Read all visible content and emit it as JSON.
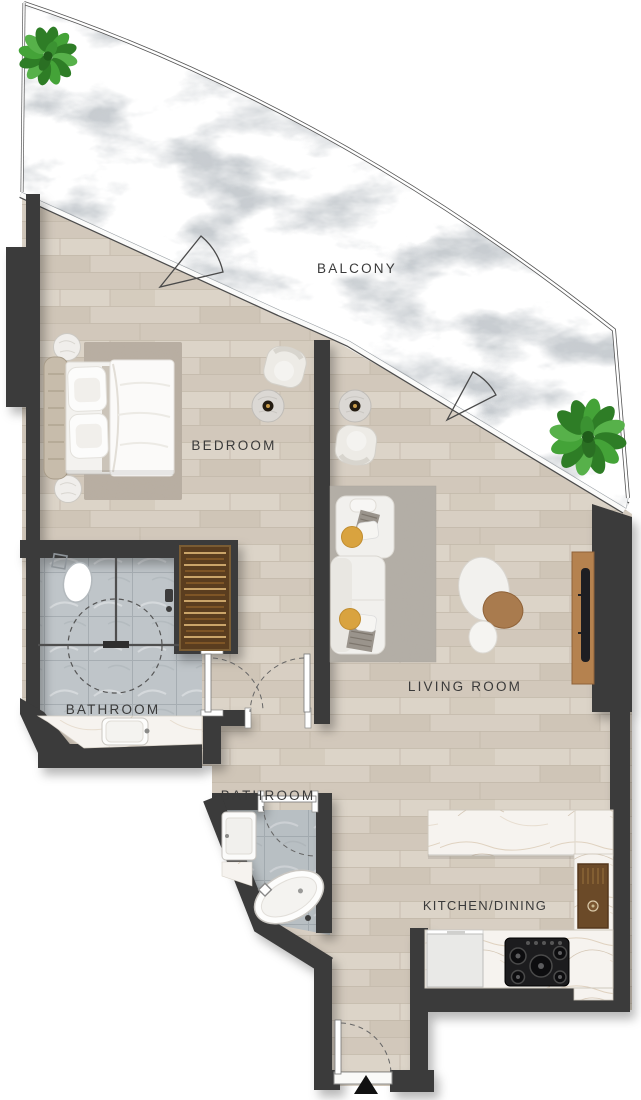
{
  "type": "floor-plan",
  "rooms": [
    {
      "id": "balcony",
      "label": "BALCONY"
    },
    {
      "id": "bedroom",
      "label": "BEDROOM"
    },
    {
      "id": "bathroom-1",
      "label": "BATHROOM"
    },
    {
      "id": "bathroom-2",
      "label": "BATHROOM"
    },
    {
      "id": "living-room",
      "label": "LIVING ROOM"
    },
    {
      "id": "kitchen-dining",
      "label": "KITCHEN/DINING"
    }
  ],
  "furniture": {
    "balcony": [
      "potted-plant",
      "potted-plant",
      "door-swing",
      "door-swing"
    ],
    "bedroom": [
      "double-bed",
      "headboard",
      "nightstand",
      "nightstand",
      "area-rug",
      "armchair",
      "side-table"
    ],
    "bathroom_1": [
      "toilet",
      "walk-in-shower",
      "shower-screen",
      "vanity-counter",
      "sink",
      "wardrobe"
    ],
    "living_room": [
      "corner-sofa",
      "throw-pillows",
      "area-rug",
      "nesting-coffee-tables",
      "tv-console",
      "tv",
      "armchair",
      "side-table"
    ],
    "bathroom_2": [
      "washbasin",
      "freestanding-bathtub"
    ],
    "kitchen_dining": [
      "kitchen-island",
      "sink-unit",
      "counter",
      "cooktop",
      "appliance"
    ]
  },
  "annotations": {
    "entrance_marker": "triangle-arrow-up"
  },
  "colors": {
    "wall": "#3a3a3a",
    "wood_floor": "#d6cdc0",
    "bathroom_tile": "#bfc5c9",
    "balcony_stone": "#c7ccd0",
    "counter_marble": "#f6f3ef",
    "wardrobe_wood": "#5a3d1f",
    "console_wood": "#b5824f",
    "accent_pillow": "#d9a33f",
    "plant_green": "#3b9232",
    "label_text": "#3a3a3a",
    "background": "#ffffff"
  }
}
